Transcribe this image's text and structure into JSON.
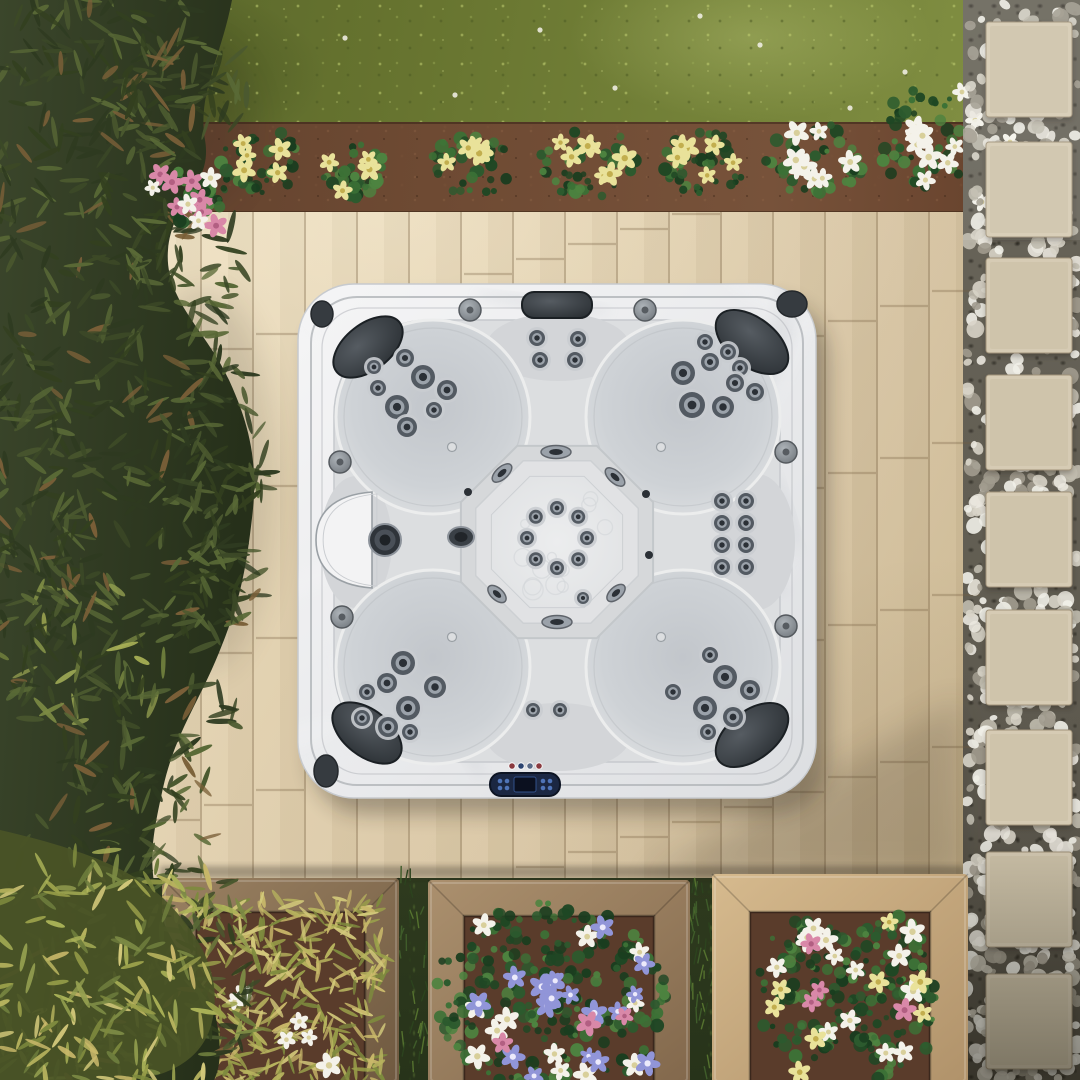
{
  "meta": {
    "title": "Aerial top-down view of a square hot tub on a beige paver patio with garden landscaping",
    "width": 1080,
    "height": 1080
  },
  "palette": {
    "pebbles": [
      "#eae7de",
      "#d8d4c8",
      "#c0bbae",
      "#a19b8e",
      "#f1efe8"
    ],
    "paver": "#d6cbb4",
    "paverDark": "#c3b79c",
    "paverEdge": "#a1937a",
    "soilPlanter": "#5a3c2b",
    "leafDark": [
      "#2e3a20",
      "#3c4927",
      "#4b592f",
      "#596936",
      "#33401f"
    ],
    "leafLight": [
      "#7c8a44",
      "#95a050",
      "#aab257",
      "#6d7c3c"
    ],
    "leafBrown": "#7a5f38",
    "needlePlant": [
      "#b7b35e",
      "#9aa04a",
      "#d2c87a",
      "#7e8a3e",
      "#c9b86a"
    ],
    "midFoliage": [
      "#2c5a2e",
      "#1f4724",
      "#3c7136",
      "#4d8340",
      "#1a3d1f"
    ],
    "blades": [
      "#3f5c2a",
      "#55722f",
      "#2c431e"
    ],
    "flowerYellow": "#e9e29a",
    "flowerYellowC": "#c2ae4e",
    "flowerWhite": "#f4f2ea",
    "flowerWhiteC": "#d8cf9a",
    "flowerBlue": "#9195d8",
    "flowerBlueC": "#eceafb",
    "flowerPink": "#d988a8",
    "flowerPinkC": "#b25f82",
    "shell1": "#f5f5f6",
    "shell2": "#e6e7e9",
    "shell3": "#dadcdf",
    "marble": "#a9afb7",
    "marbleLight": "#f6f7f8",
    "basin": "#dcdee0",
    "bench": "#d3d5d8",
    "lobeIn": "#c2c6cb",
    "lobeOut": "#e5e6e8",
    "octo1": "#d6d8da",
    "octo2": "#e1e2e4",
    "floor": "#e9eaeb",
    "floorLine": "#cdd0d3",
    "rimLine": "#b4b7bb",
    "pillow1": "#51575d",
    "pillow2": "#24292d",
    "pillowEdge": "#1b2024",
    "jetFlange": "#c9ccd0",
    "jetRing": "#535a62",
    "jetMetal": "#9ba2aa",
    "jetDark": "#2b3036",
    "knob1": "#a7adb2",
    "knob2": "#6e747a",
    "knobEdge": "#54595e",
    "disc": "#363b40",
    "discEdge": "#24282c",
    "panelBody": "#1b2742",
    "panelEdge": "#0d1423",
    "screen": "#0b101f",
    "screenEdge": "#32508a",
    "btnBlue": "#4f74b8",
    "shadow": "#241f16",
    "woodGapGrass": "#26331a"
  },
  "garden": {
    "pavers": {
      "x": 986,
      "w": 86,
      "h": 95,
      "ys": [
        22,
        142,
        258,
        375,
        492,
        610,
        730,
        852,
        974
      ]
    },
    "pebbleField": {
      "x0": 966,
      "x1": 1078,
      "y0": 0,
      "y1": 1080,
      "count": 640
    },
    "bedClumps": [
      {
        "x": 262,
        "y": 163,
        "rx": 42,
        "ry": 34,
        "f": "yellow",
        "n": 5
      },
      {
        "x": 352,
        "y": 170,
        "rx": 34,
        "ry": 28,
        "f": "yellow",
        "n": 4
      },
      {
        "x": 470,
        "y": 166,
        "rx": 40,
        "ry": 32,
        "f": "yellow",
        "n": 5
      },
      {
        "x": 588,
        "y": 162,
        "rx": 48,
        "ry": 36,
        "f": "yellow",
        "n": 7
      },
      {
        "x": 703,
        "y": 166,
        "rx": 44,
        "ry": 34,
        "f": "yellow",
        "n": 6
      },
      {
        "x": 815,
        "y": 158,
        "rx": 50,
        "ry": 38,
        "f": "white",
        "n": 8
      },
      {
        "x": 922,
        "y": 142,
        "rx": 46,
        "ry": 54,
        "f": "white",
        "n": 9
      },
      {
        "x": 186,
        "y": 196,
        "rx": 30,
        "ry": 24,
        "f": "pink",
        "n": 6
      }
    ],
    "extraWhiteFlowers": [
      [
        975,
        120
      ],
      [
        997,
        163
      ],
      [
        982,
        202
      ],
      [
        1010,
        142
      ],
      [
        962,
        92
      ]
    ],
    "grassSpecks": [
      [
        345,
        38
      ],
      [
        455,
        95
      ],
      [
        540,
        30
      ],
      [
        615,
        88
      ],
      [
        760,
        45
      ],
      [
        850,
        108
      ],
      [
        700,
        16
      ],
      [
        905,
        72
      ]
    ],
    "planters": [
      {
        "id": "planter-left",
        "x": 162,
        "y": 878,
        "w": 237,
        "h": 206,
        "frame": 34,
        "wood": [
          "#9a8162",
          "#6f5940"
        ],
        "fill": "needles",
        "white": 6,
        "yellow": 0,
        "blue": 0,
        "pink": 0
      },
      {
        "id": "planter-middle",
        "x": 428,
        "y": 880,
        "w": 262,
        "h": 204,
        "frame": 36,
        "wood": [
          "#ab906e",
          "#82684c"
        ],
        "fill": "foliage",
        "white": 12,
        "yellow": 0,
        "blue": 18,
        "pink": 3
      },
      {
        "id": "planter-right",
        "x": 712,
        "y": 874,
        "w": 256,
        "h": 210,
        "frame": 38,
        "wood": [
          "#d6ba8e",
          "#b0926a"
        ],
        "fill": "mixed",
        "white": 14,
        "yellow": 8,
        "blue": 0,
        "pink": 4
      }
    ],
    "gaps": [
      {
        "x": 399,
        "w": 29
      },
      {
        "x": 690,
        "w": 22
      }
    ],
    "tree": {
      "path": "M0,0 L232,0 C221,58 197,94 205,140 C213,186 172,200 168,250 C164,300 206,330 229,380 C252,430 258,468 252,518 C246,570 240,600 222,645 C201,700 176,730 163,788 C152,838 148,860 158,904 C170,954 205,974 216,1018 C223,1054 219,1070 214,1080 L0,1080 Z",
      "zones": [
        {
          "cx": 110,
          "cy": 60,
          "rx": 120,
          "ry": 70,
          "n": 90
        },
        {
          "cx": 185,
          "cy": 95,
          "rx": 70,
          "ry": 60,
          "n": 60
        },
        {
          "cx": 90,
          "cy": 200,
          "rx": 110,
          "ry": 90,
          "n": 90
        },
        {
          "cx": 190,
          "cy": 260,
          "rx": 60,
          "ry": 60,
          "n": 50
        },
        {
          "cx": 110,
          "cy": 380,
          "rx": 120,
          "ry": 100,
          "n": 95
        },
        {
          "cx": 225,
          "cy": 440,
          "rx": 55,
          "ry": 75,
          "n": 55
        },
        {
          "cx": 120,
          "cy": 560,
          "rx": 120,
          "ry": 95,
          "n": 90
        },
        {
          "cx": 215,
          "cy": 590,
          "rx": 50,
          "ry": 60,
          "n": 45
        },
        {
          "cx": 80,
          "cy": 660,
          "rx": 90,
          "ry": 80,
          "n": 65,
          "light": true
        },
        {
          "cx": 150,
          "cy": 740,
          "rx": 90,
          "ry": 80,
          "n": 70
        },
        {
          "cx": 40,
          "cy": 500,
          "rx": 60,
          "ry": 200,
          "n": 80
        },
        {
          "cx": 120,
          "cy": 880,
          "rx": 120,
          "ry": 90,
          "n": 85
        },
        {
          "cx": 170,
          "cy": 990,
          "rx": 90,
          "ry": 85,
          "n": 75
        },
        {
          "cx": 80,
          "cy": 1020,
          "rx": 95,
          "ry": 75,
          "n": 80,
          "light": true
        }
      ],
      "pinkCluster": {
        "x0": 148,
        "y0": 168,
        "x1": 228,
        "y1": 232,
        "pink": 7,
        "white": 4
      }
    },
    "shrub": {
      "path": "M0,830 C70,846 130,866 165,900 C205,940 222,980 212,1022 C202,1064 160,1080 120,1080 L0,1080 Z",
      "zone": {
        "cx": 115,
        "cy": 975,
        "rx": 150,
        "ry": 130,
        "n": 170
      }
    },
    "shadows": {
      "patioDiagonal": "640,880 963,698 963,880",
      "planterStrip": {
        "x": 160,
        "y": 866,
        "w": 805,
        "h": 12
      },
      "treeBlobs": [
        [
          205,
          480,
          70,
          190
        ],
        [
          195,
          125,
          60,
          85
        ]
      ],
      "gravelBottom": {
        "x": 963,
        "y": 820,
        "w": 117,
        "h": 260
      }
    }
  },
  "tub": {
    "shell": {
      "x": 298,
      "y": 284,
      "w": 518,
      "h": 514,
      "r": 56
    },
    "rim": {
      "x": 311,
      "y": 297,
      "w": 492,
      "h": 488,
      "r": 46
    },
    "contour": {
      "x": 322,
      "y": 308,
      "w": 470,
      "h": 466,
      "r": 40
    },
    "basin": {
      "x": 334,
      "y": 320,
      "w": 446,
      "h": 442,
      "r": 95
    },
    "lobes": {
      "r": 97,
      "centers": [
        [
          433,
          417
        ],
        [
          683,
          417
        ],
        [
          433,
          667
        ],
        [
          683,
          667
        ]
      ]
    },
    "benches": [
      [
        558,
        347,
        72,
        34
      ],
      [
        558,
        737,
        72,
        34
      ],
      [
        356,
        542,
        36,
        66
      ],
      [
        757,
        542,
        38,
        68
      ]
    ],
    "octagon": {
      "cx": 557,
      "cy": 542,
      "r1": 104,
      "r2": 88,
      "r3": 71
    },
    "ringJets": {
      "cx": 557,
      "cy": 538,
      "r": 30,
      "jr": 7,
      "count": 8
    },
    "clusters": [
      {
        "id": "jet-cluster-top-left",
        "jets": [
          [
            405,
            358,
            9
          ],
          [
            423,
            377,
            12
          ],
          [
            447,
            390,
            10
          ],
          [
            378,
            388,
            8
          ],
          [
            397,
            407,
            12
          ],
          [
            407,
            427,
            10
          ],
          [
            374,
            367,
            7
          ],
          [
            434,
            410,
            8
          ]
        ]
      },
      {
        "id": "jet-cluster-top-right",
        "jets": [
          [
            705,
            342,
            8
          ],
          [
            728,
            352,
            8
          ],
          [
            683,
            373,
            12
          ],
          [
            710,
            362,
            9
          ],
          [
            740,
            368,
            8
          ],
          [
            692,
            405,
            13
          ],
          [
            723,
            407,
            11
          ],
          [
            755,
            392,
            9
          ],
          [
            735,
            383,
            9
          ]
        ]
      },
      {
        "id": "jet-cluster-bottom-left",
        "jets": [
          [
            403,
            663,
            12
          ],
          [
            387,
            683,
            10
          ],
          [
            435,
            687,
            11
          ],
          [
            367,
            692,
            8
          ],
          [
            408,
            708,
            12
          ],
          [
            388,
            727,
            10
          ],
          [
            362,
            718,
            8
          ],
          [
            410,
            732,
            8
          ]
        ]
      },
      {
        "id": "jet-cluster-bottom-right",
        "jets": [
          [
            710,
            655,
            8
          ],
          [
            725,
            677,
            12
          ],
          [
            750,
            690,
            10
          ],
          [
            673,
            692,
            8
          ],
          [
            705,
            708,
            12
          ],
          [
            733,
            717,
            10
          ],
          [
            708,
            732,
            8
          ]
        ]
      }
    ],
    "topBenchJets": [
      [
        537,
        338,
        8
      ],
      [
        578,
        339,
        8
      ],
      [
        540,
        360,
        8
      ],
      [
        575,
        360,
        8
      ]
    ],
    "rightBenchJets": [
      [
        722,
        501,
        8
      ],
      [
        746,
        501,
        8
      ],
      [
        722,
        523,
        8
      ],
      [
        746,
        523,
        8
      ],
      [
        722,
        545,
        8
      ],
      [
        746,
        545,
        8
      ],
      [
        722,
        567,
        8
      ],
      [
        746,
        567,
        8
      ]
    ],
    "bottomBenchJets": [
      [
        533,
        710,
        7
      ],
      [
        560,
        710,
        7
      ]
    ],
    "extraJet": [
      583,
      598,
      6
    ],
    "wallOvals": [
      [
        556,
        452,
        30,
        13,
        0
      ],
      [
        502,
        473,
        24,
        12,
        -42
      ],
      [
        615,
        477,
        24,
        12,
        42
      ],
      [
        497,
        594,
        22,
        12,
        42
      ],
      [
        616,
        593,
        22,
        12,
        -42
      ],
      [
        557,
        622,
        30,
        13,
        0
      ]
    ],
    "bigWallJet": [
      461,
      537,
      26,
      20
    ],
    "wallDots": [
      [
        646,
        494,
        4
      ],
      [
        649,
        555,
        4
      ],
      [
        468,
        492,
        4
      ]
    ],
    "screws": [
      [
        452,
        637
      ],
      [
        661,
        637
      ],
      [
        452,
        447
      ],
      [
        661,
        447
      ]
    ],
    "knobs": [
      [
        470,
        310
      ],
      [
        645,
        310
      ],
      [
        340,
        462
      ],
      [
        342,
        617
      ],
      [
        786,
        452
      ],
      [
        786,
        626
      ]
    ],
    "pillows": [
      [
        368,
        347,
        40,
        23,
        -38
      ],
      [
        752,
        342,
        42,
        24,
        38
      ],
      [
        367,
        733,
        40,
        23,
        38
      ],
      [
        752,
        735,
        42,
        24,
        -38
      ]
    ],
    "topPillow": {
      "x": 522,
      "y": 292,
      "w": 70,
      "h": 26,
      "r": 12
    },
    "cornerDiscs": [
      [
        322,
        314,
        11,
        13
      ],
      [
        792,
        304,
        15,
        13
      ],
      [
        326,
        771,
        12,
        16
      ]
    ],
    "waterfall": {
      "path": "M372,492 C332,495 316,514 316,540 C316,566 332,585 372,588 Z"
    },
    "filterCap": {
      "cx": 385,
      "cy": 540,
      "r": 16
    },
    "panel": {
      "indicatorDots": [
        [
          512,
          766,
          "#8a3a3f"
        ],
        [
          521,
          766,
          "#2c4470"
        ],
        [
          530,
          766,
          "#5a6a86"
        ],
        [
          539,
          766,
          "#8a3a3f"
        ]
      ],
      "body": {
        "x": 490,
        "y": 773,
        "w": 70,
        "h": 23,
        "r": 11
      },
      "screen": {
        "x": 514,
        "y": 777,
        "w": 22,
        "h": 15
      },
      "buttons": [
        [
          500,
          781
        ],
        [
          507,
          781
        ],
        [
          500,
          788
        ],
        [
          507,
          788
        ],
        [
          543,
          781
        ],
        [
          550,
          781
        ],
        [
          543,
          788
        ],
        [
          550,
          788
        ]
      ]
    },
    "marbleStreakCount": 26
  },
  "patioJoints": {
    "x0": 150,
    "colW": 52,
    "cols": 16,
    "y0": 212,
    "y1": 880,
    "rowH": 152,
    "stagger": 137
  }
}
